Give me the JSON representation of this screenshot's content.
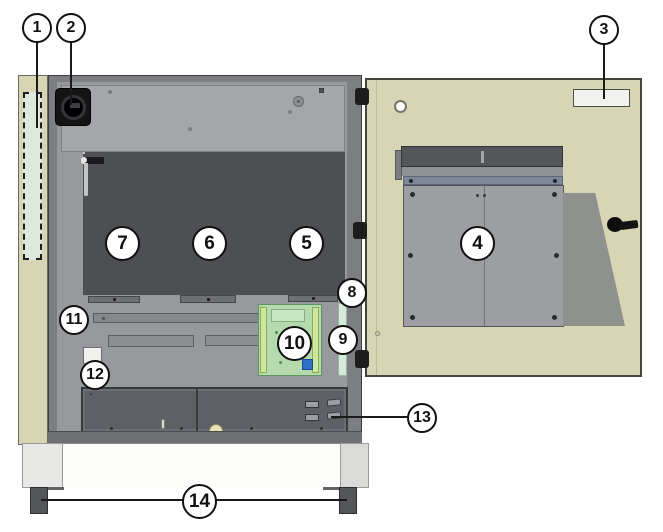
{
  "figure": {
    "description": "Exploded front view of an equipment cabinet with opened right-hand door and numbered component callouts",
    "callouts": [
      {
        "label": "1"
      },
      {
        "label": "2"
      },
      {
        "label": "3"
      },
      {
        "label": "4"
      },
      {
        "label": "5"
      },
      {
        "label": "6"
      },
      {
        "label": "7"
      },
      {
        "label": "8"
      },
      {
        "label": "9"
      },
      {
        "label": "10"
      },
      {
        "label": "11"
      },
      {
        "label": "12"
      },
      {
        "label": "13"
      },
      {
        "label": "14"
      }
    ]
  },
  "counts": {
    "modules": 3,
    "module_vent_slots": 3,
    "door_grille_slots": 24,
    "bottom_panel_slots": 8,
    "indicator_cells": 12
  },
  "colors": {
    "cabinet_beige": "#d8d5b4",
    "region_cyan": "#dceade",
    "frame_gray": "#7d7e82",
    "interior_gray": "#98999d",
    "module_white": "#eff0ee",
    "pcb_green": "#b4daae",
    "chip_blue": "#2e6ec6",
    "strip_cyan": "#d5e9dc",
    "panel_dark": "#5d6064",
    "slot_gray": "#a0a3a7",
    "foot_dark": "#54565a"
  }
}
